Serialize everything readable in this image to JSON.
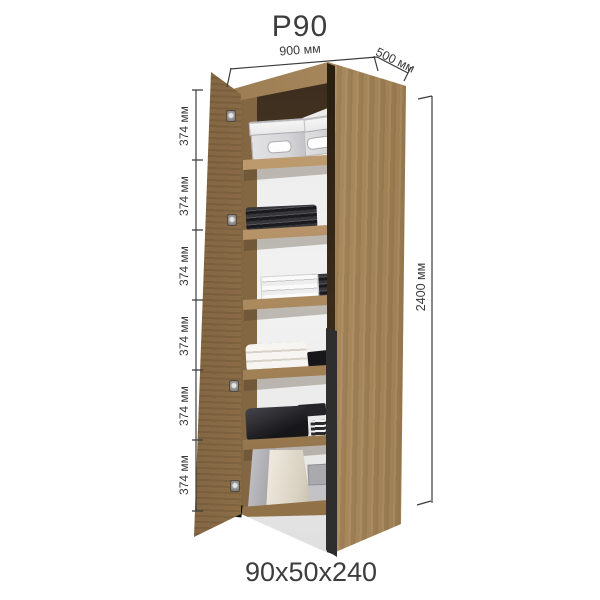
{
  "title": "P90",
  "footer_size": "90x50x240",
  "dimensions": {
    "width_label": "900 мм",
    "depth_label": "500 мм",
    "height_label": "2400 мм",
    "section_labels": [
      "374 мм",
      "374 мм",
      "374 мм",
      "374 мм",
      "374 мм",
      "374 мм"
    ]
  },
  "colors": {
    "wood": "#a8895e",
    "wood_dark": "#6b5136",
    "handle": "#151515",
    "dimension_line": "#3c3c3c",
    "text": "#3d3d3d",
    "interior_back": "#ececec",
    "background": "#ffffff"
  }
}
